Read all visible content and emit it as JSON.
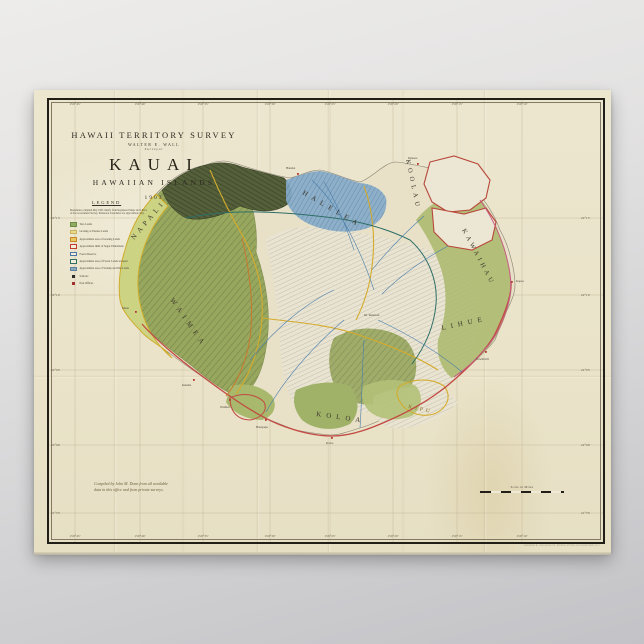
{
  "poster": {
    "title_block": {
      "line1": "HAWAII TERRITORY SURVEY",
      "line2": "WALTER E. WALL",
      "line3": "Surveyor",
      "title": "KAUAI",
      "subtitle": "HAWAIIAN ISLANDS",
      "year": "1903"
    },
    "legend": {
      "heading": "LEGEND",
      "note_line1": "Boundaries compiled May 1903 chiefly from Registered Maps and Charts",
      "note_line2": "of the Government Survey. Plantation boundaries are approximate only.",
      "items": [
        {
          "label": "Taro Lands",
          "fill": "#8fae62",
          "border": "#6e8a46"
        },
        {
          "label": "Grazing or Pasture Lands",
          "fill": "#ead98f",
          "border": "#c9b55f"
        },
        {
          "label": "Approximate area of Grazing Lands",
          "fill": "#e5c95f",
          "border": "#c9862e"
        },
        {
          "label": "Approximate limit of Sugar Plantations",
          "fill": "#f2ecd9",
          "border": "#c13b30"
        },
        {
          "label": "Forest Reserve",
          "fill": "#f2ecd9",
          "border": "#4a76a8"
        },
        {
          "label": "Approximate area of Forest Lands set apart",
          "fill": "#f2ecd9",
          "border": "#2f6f66"
        },
        {
          "label": "Approximate area of Swamp and Wet Lands",
          "fill": "#8aa7bd",
          "border": "#5d82a0"
        },
        {
          "label": "Schools",
          "fill": "#2b2b2b",
          "border": "#2b2b2b"
        },
        {
          "label": "Post Offices",
          "fill": "#a03030",
          "border": "#a03030"
        }
      ]
    },
    "graticule": {
      "longitudes": [
        "159°45'",
        "159°40'",
        "159°35'",
        "159°30'",
        "159°25'",
        "159°20'",
        "159°15'",
        "159°10'"
      ],
      "latitudes": [
        "22°15'",
        "22°10'",
        "22°05'",
        "22°00'",
        "21°55'"
      ]
    },
    "districts": [
      {
        "name": "NAPALI"
      },
      {
        "name": "HALELEA"
      },
      {
        "name": "KOOLAU"
      },
      {
        "name": "KAWAIHAU"
      },
      {
        "name": "LIHUE"
      },
      {
        "name": "KOLOA"
      },
      {
        "name": "WAIMEA"
      },
      {
        "name": "KIPU"
      }
    ],
    "places": [
      {
        "name": "Mana"
      },
      {
        "name": "Kekaha"
      },
      {
        "name": "Waimea"
      },
      {
        "name": "Hanapepe"
      },
      {
        "name": "Koloa"
      },
      {
        "name": "Nawiliwili"
      },
      {
        "name": "Kapaa"
      },
      {
        "name": "Kilauea"
      },
      {
        "name": "Hanalei"
      },
      {
        "name": "Mt. Waialeale"
      }
    ],
    "notes": {
      "compiled_line1": "Compiled by John M. Donn from all available",
      "compiled_line2": "data in this office and from private surveys."
    },
    "scale": {
      "label": "Scale in Miles"
    },
    "imprint": "ANDREW B. GRAHAM CO. PHOTO-LITHO. WASHINGTON, D.C."
  }
}
